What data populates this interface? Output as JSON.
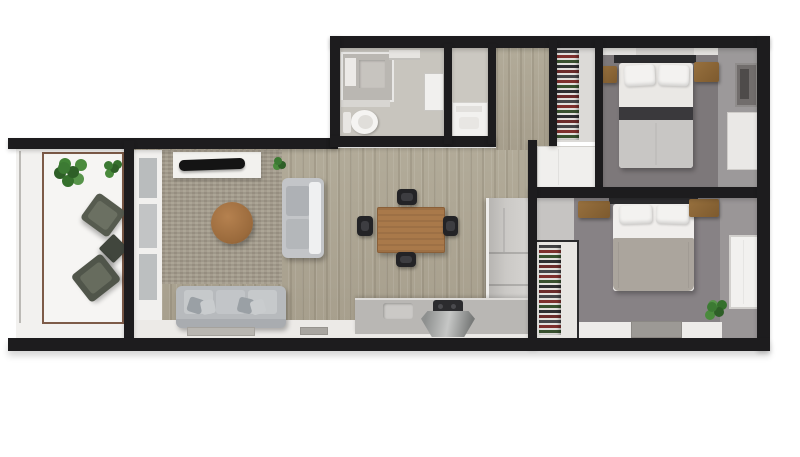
{
  "scene": {
    "description": "3D top-down rendering of a two-bedroom apartment floor plan on a white background",
    "background_color": "#ffffff"
  },
  "palette": {
    "wall": "#1d1c1e",
    "wood_floor": "#aca492",
    "living_rug": "#a49c8c",
    "bedroom1_floor": "#7d787a",
    "bedroom2_floor": "#878285",
    "bathroom_floor": "#c8c5be",
    "balcony_floor": "#f5f4f2",
    "balcony_trim": "#7d5b48",
    "sofa_gray": "#b7babd",
    "dining_wood": "#a9794a",
    "coffee_table_wood": "#a8744a",
    "nightstand_brown": "#8a6135",
    "plant_green": "#3e7a33",
    "duvet_taupe": "#aba59d",
    "bed_accent_band": "#3a393c",
    "counter_gray": "#b9b7b4",
    "closet_interior": "#dcdad7"
  },
  "rooms": [
    {
      "id": "balcony",
      "label": "Balcony",
      "furniture": [
        "potted-plant-large",
        "potted-plant-small",
        "lounge-chair",
        "side-table",
        "lounge-chair"
      ]
    },
    {
      "id": "living-room",
      "label": "Living room",
      "furniture": [
        "tv-console",
        "tv",
        "area-rug",
        "round-coffee-table",
        "loveseat",
        "three-seat-sofa",
        "pillows",
        "doormat",
        "doormat"
      ]
    },
    {
      "id": "dining-area",
      "label": "Dining area",
      "furniture": [
        "dining-table",
        "dining-chair",
        "dining-chair",
        "dining-chair",
        "dining-chair"
      ]
    },
    {
      "id": "kitchen",
      "label": "Kitchen",
      "furniture": [
        "tall-cabinet-and-fridge",
        "base-counter",
        "sink",
        "cooktop",
        "sink-cabinet"
      ]
    },
    {
      "id": "bathroom",
      "label": "Bathroom",
      "furniture": [
        "shower-enclosure",
        "shelf",
        "toilet",
        "towel-rail",
        "wall-cabinet-door"
      ]
    },
    {
      "id": "laundry",
      "label": "Laundry closet",
      "furniture": [
        "washing-machine"
      ]
    },
    {
      "id": "hallway",
      "label": "Hallway",
      "furniture": []
    },
    {
      "id": "closet-1",
      "label": "Wardrobe closet",
      "furniture": [
        "hanging-clothes",
        "shelving",
        "low-cabinet"
      ]
    },
    {
      "id": "bedroom-1",
      "label": "Bedroom 1",
      "furniture": [
        "double-bed",
        "headboard",
        "pillows",
        "nightstand",
        "nightstand",
        "ceiling-rug-panel",
        "window",
        "door-panel"
      ]
    },
    {
      "id": "bedroom-2",
      "label": "Bedroom 2",
      "furniture": [
        "double-bed",
        "headboard",
        "pillows",
        "nightstand",
        "nightstand",
        "open-wardrobe",
        "potted-plant",
        "rug",
        "window"
      ]
    }
  ]
}
